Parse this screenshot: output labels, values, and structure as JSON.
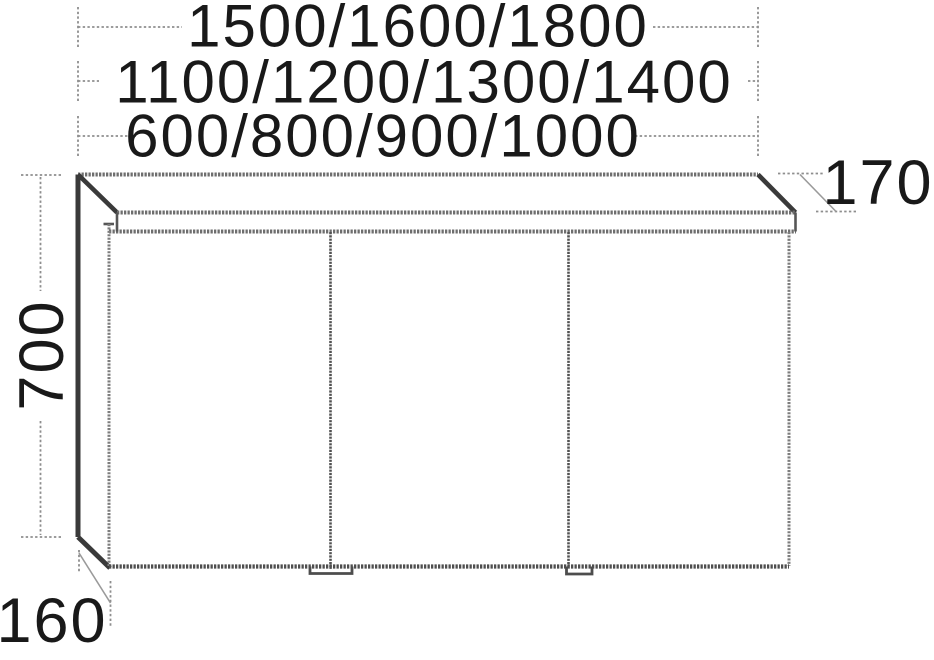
{
  "meta": {
    "description": "Technical dimension drawing of a three-door mirror cabinet with light canopy",
    "colors": {
      "background": "#ffffff",
      "outline": "#3a3a3a",
      "edge": "#6e6e6e",
      "dimension_line": "#8e8e8e",
      "text": "#191919"
    }
  },
  "dimensions": {
    "width_row_1": "1500/1600/1800",
    "width_row_2": "1100/1200/1300/1400",
    "width_row_3": "600/800/900/1000",
    "height": "700",
    "canopy_depth": "170",
    "carcass_depth": "160"
  }
}
